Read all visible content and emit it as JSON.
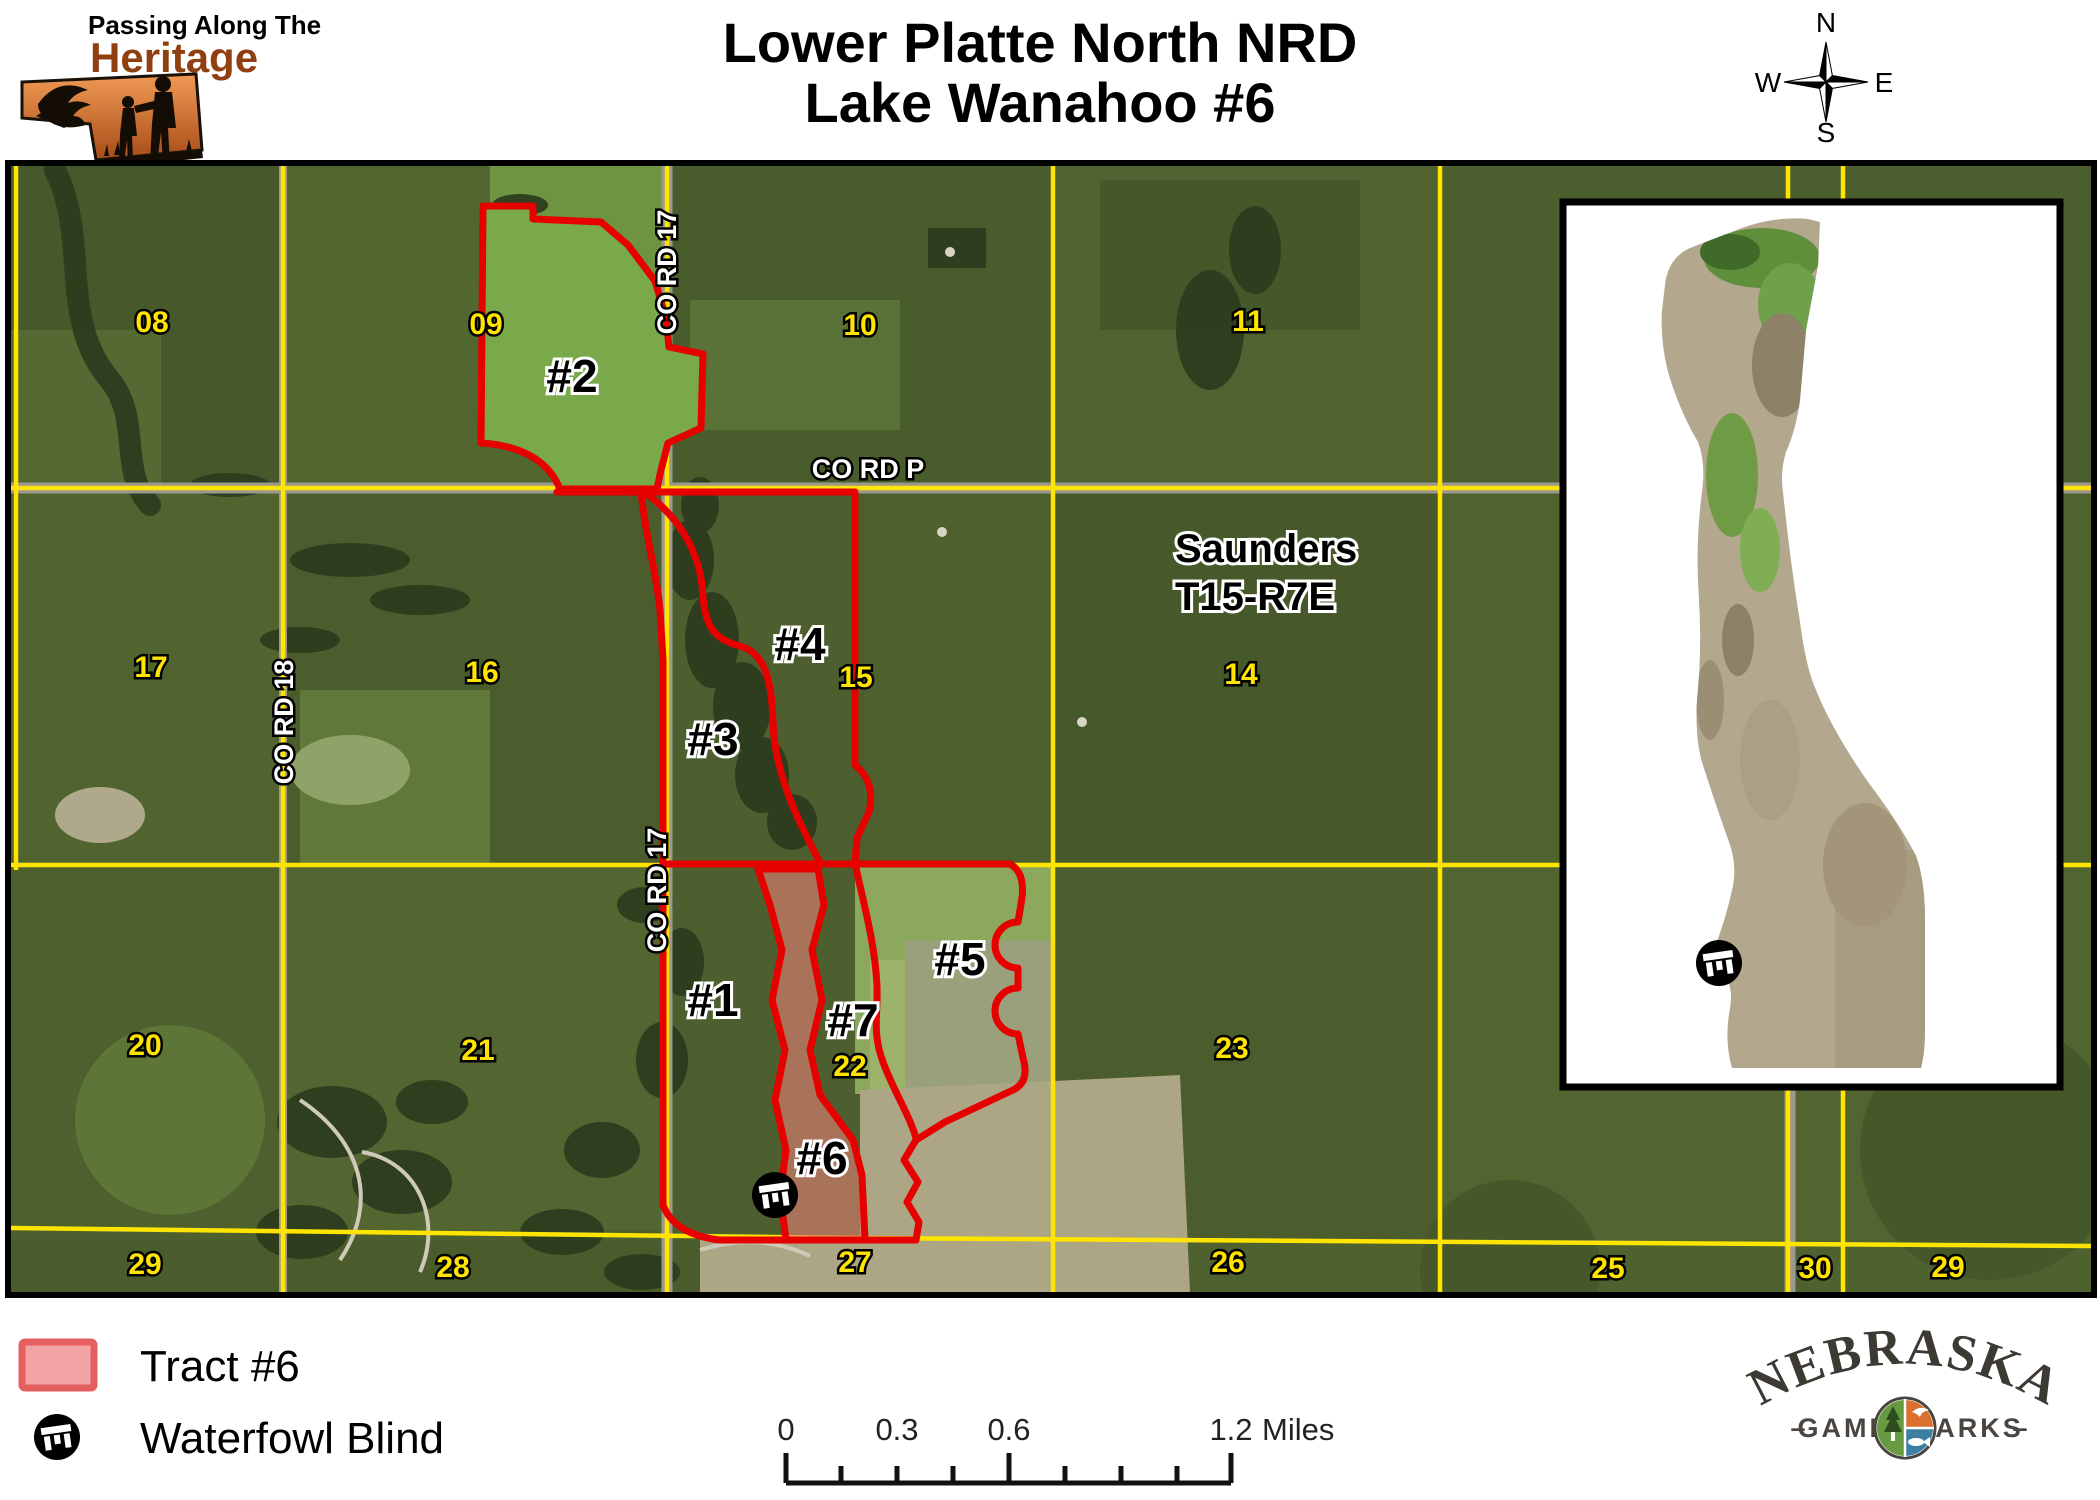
{
  "header": {
    "title_line1": "Lower Platte North NRD",
    "title_line2": "Lake Wanahoo #6"
  },
  "heritage_logo": {
    "line1": "Passing Along The",
    "line2": "Heritage"
  },
  "compass": {
    "n": "N",
    "w": "W",
    "e": "E",
    "s": "S"
  },
  "map": {
    "region_line1": "Saunders",
    "region_line2": "T15-R7E",
    "roads": {
      "co_rd_17_top": "CO RD 17",
      "co_rd_17_bottom": "CO RD 17",
      "co_rd_18": "CO RD 18",
      "co_rd_p": "CO RD P"
    },
    "section_numbers": [
      "08",
      "09",
      "10",
      "11",
      "17",
      "16",
      "15",
      "14",
      "20",
      "21",
      "22",
      "23",
      "29",
      "28",
      "27",
      "26",
      "25",
      "30",
      "29"
    ],
    "tracts": [
      "#1",
      "#2",
      "#3",
      "#4",
      "#5",
      "#6",
      "#7"
    ]
  },
  "legend": {
    "tract_swatch_label": "Tract #6",
    "blind_label": "Waterfowl Blind"
  },
  "scalebar": {
    "t0": "0",
    "t1": "0.3",
    "t2": "0.6",
    "t3": "1.2",
    "unit": "Miles"
  },
  "ngpc_logo": {
    "name": "NEBRASKA",
    "game": "GAME",
    "parks": "PARKS",
    "dash_left": "–",
    "dash_right": "–"
  },
  "colors": {
    "tract_outline": "#e60000",
    "tract6_fill": "#e07f72",
    "section_label": "#ffe400",
    "road_line": "#ffe400",
    "legend_swatch_fill": "#f2a3a3",
    "legend_swatch_border": "#e65f5f"
  }
}
